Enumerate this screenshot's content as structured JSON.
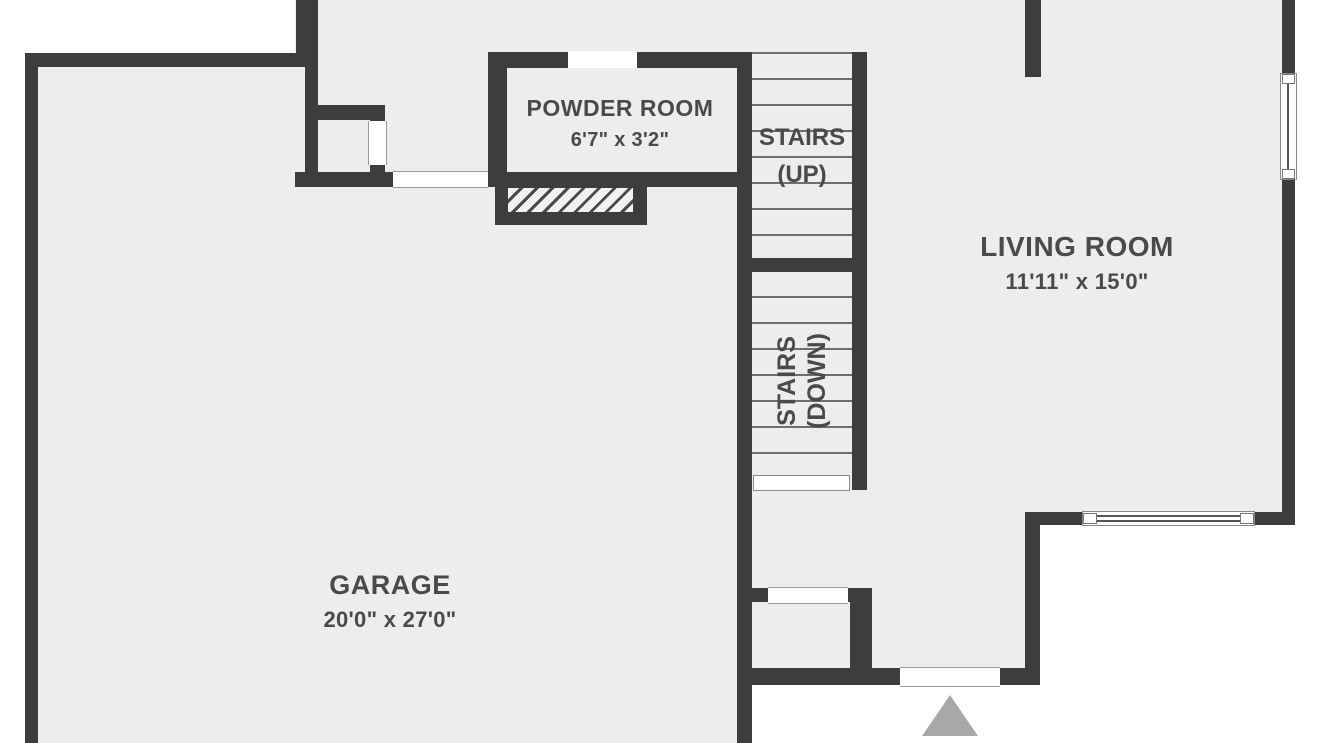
{
  "plan": {
    "type": "floor-plan",
    "rooms": [
      {
        "id": "powder-room",
        "label": "POWDER ROOM",
        "dimensions": "6'7\" x 3'2\""
      },
      {
        "id": "stairs-up",
        "label": "STAIRS",
        "direction": "(UP)"
      },
      {
        "id": "stairs-down",
        "label": "STAIRS",
        "direction": "(DOWN)"
      },
      {
        "id": "living-room",
        "label": "LIVING ROOM",
        "dimensions": "11'11\" x 15'0\""
      },
      {
        "id": "garage",
        "label": "GARAGE",
        "dimensions": "20'0\" x 27'0\""
      }
    ],
    "markers": {
      "entrance": "triangle-up-icon"
    },
    "colors": {
      "wall": "#3d3d3d",
      "floor": "#ededed",
      "exterior": "#ffffff",
      "text": "#4a4a4a",
      "entrance_marker": "#a8a8a8"
    }
  }
}
